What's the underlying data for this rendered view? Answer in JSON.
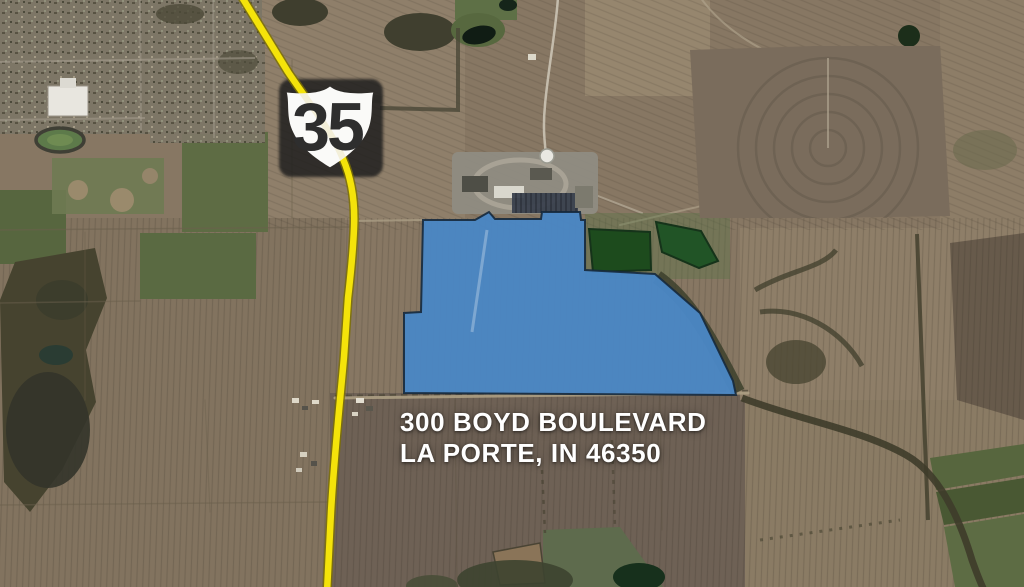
{
  "map": {
    "route_shield": {
      "number": "35"
    },
    "address": {
      "line1": "300 BOYD BOULEVARD",
      "line2": "LA PORTE, IN 46350"
    },
    "colors": {
      "parcel_fill": "#4A86C4",
      "parcel_outline": "#16293C",
      "highway": "#F4E30A",
      "highway_casing": "#7D7100",
      "shield_fill": "#FAFAF8",
      "shield_numeral": "#2E2E2E",
      "shield_shadow": "#1C1C1C",
      "label_text": "#FFFFFF"
    }
  }
}
